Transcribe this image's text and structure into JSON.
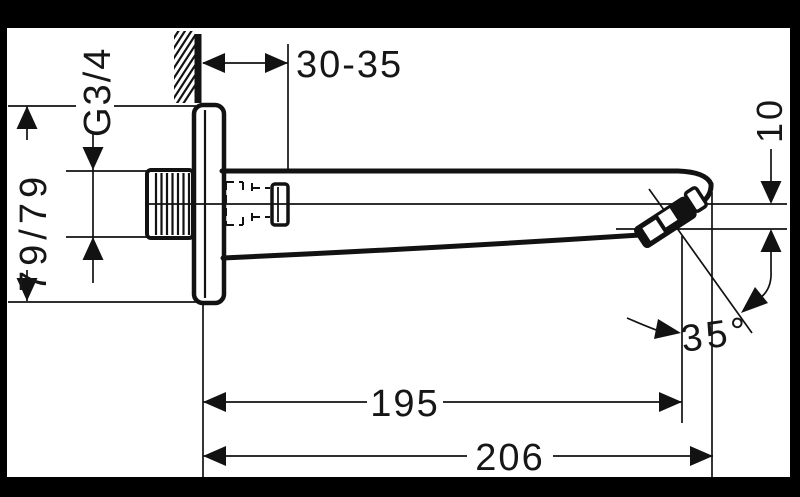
{
  "drawing": {
    "type": "technical-dimension-drawing",
    "subject": "wall-mounted bath spout, side elevation",
    "colors": {
      "canvas": "#ffffff",
      "frame": "#000000",
      "ink": "#121212"
    },
    "labels": {
      "wall_distance": "30-35",
      "thread": "G3/4",
      "plate": "79/79",
      "outlet_drop": "10",
      "reach_aerator": "195",
      "reach_total": "206",
      "angle": "35°"
    }
  }
}
